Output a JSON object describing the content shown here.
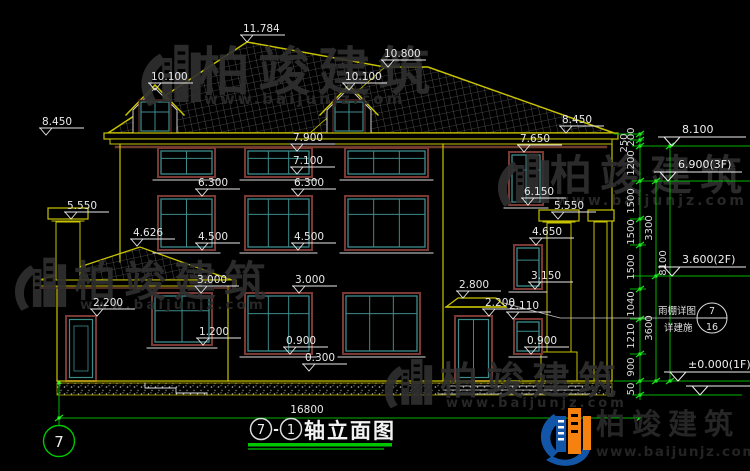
{
  "colors": {
    "cad_yellow": "#c9c400",
    "cad_green": "#00b400",
    "green_dot": "#2bff2b",
    "dim_white": "#e8e8e8",
    "frame_brown": "#7a3a33",
    "frame_teal": "#3d8c8c",
    "watermark_gray": "#2f2f2f",
    "logo_blue": "#1356a8",
    "logo_orange": "#f5820f"
  },
  "brand": {
    "name": "柏竣建筑",
    "url": "www.baijunjz.com"
  },
  "title_block": {
    "axis_a": "7",
    "dash": "-",
    "axis_b": "1",
    "text": "轴立面图"
  },
  "bottom": {
    "overall_dim": "16800",
    "grid_bubble": "7"
  },
  "callout": {
    "line1": "雨棚详图",
    "line2": "详建施",
    "detail_no": "7",
    "sheet_no": "16"
  },
  "drawing": {
    "marks": [
      {
        "t": "11.784",
        "x": 247,
        "y": 42
      },
      {
        "t": "10.100",
        "x": 155,
        "y": 90
      },
      {
        "t": "10.100",
        "x": 349,
        "y": 90
      },
      {
        "t": "10.800",
        "x": 388,
        "y": 67
      },
      {
        "t": "8.450",
        "x": 46,
        "y": 135
      },
      {
        "t": "8.450",
        "x": 566,
        "y": 133
      },
      {
        "t": "7.900",
        "x": 297,
        "y": 151
      },
      {
        "t": "7.650",
        "x": 524,
        "y": 152
      },
      {
        "t": "7.100",
        "x": 297,
        "y": 174
      },
      {
        "t": "6.300",
        "x": 202,
        "y": 196
      },
      {
        "t": "6.300",
        "x": 298,
        "y": 196
      },
      {
        "t": "6.150",
        "x": 528,
        "y": 205
      },
      {
        "t": "5.550",
        "x": 71,
        "y": 219
      },
      {
        "t": "5.550",
        "x": 558,
        "y": 219
      },
      {
        "t": "4.626",
        "x": 137,
        "y": 246
      },
      {
        "t": "4.500",
        "x": 202,
        "y": 250
      },
      {
        "t": "4.500",
        "x": 298,
        "y": 250
      },
      {
        "t": "4.650",
        "x": 536,
        "y": 245
      },
      {
        "t": "3.150",
        "x": 535,
        "y": 289
      },
      {
        "t": "3.000",
        "x": 201,
        "y": 293
      },
      {
        "t": "3.000",
        "x": 299,
        "y": 293
      },
      {
        "t": "2.800",
        "x": 463,
        "y": 298
      },
      {
        "t": "2.200",
        "x": 97,
        "y": 316
      },
      {
        "t": "2.200",
        "x": 489,
        "y": 316
      },
      {
        "t": "2.110",
        "x": 513,
        "y": 319
      },
      {
        "t": "1.200",
        "x": 203,
        "y": 345
      },
      {
        "t": "0.900",
        "x": 290,
        "y": 354
      },
      {
        "t": "0.900",
        "x": 531,
        "y": 354
      },
      {
        "t": "0.300",
        "x": 309,
        "y": 371
      }
    ],
    "levels": [
      {
        "t": "8.100",
        "x": 672,
        "y": 146
      },
      {
        "t": "6.900(3F)",
        "x": 668,
        "y": 181
      },
      {
        "t": "3.600(2F)",
        "x": 672,
        "y": 276
      },
      {
        "t": "±0.000(1F)",
        "x": 678,
        "y": 381
      },
      {
        "t": "",
        "x": 700,
        "y": 395
      }
    ],
    "chain": [
      {
        "x": 634,
        "y": 137,
        "t": "200"
      },
      {
        "x": 627,
        "y": 143,
        "t": "250"
      },
      {
        "x": 634,
        "y": 163,
        "t": "1200"
      },
      {
        "x": 634,
        "y": 201,
        "t": "1500"
      },
      {
        "x": 634,
        "y": 232,
        "t": "1500"
      },
      {
        "x": 634,
        "y": 267,
        "t": "1500"
      },
      {
        "x": 634,
        "y": 304,
        "t": "1040"
      },
      {
        "x": 634,
        "y": 336,
        "t": "1210"
      },
      {
        "x": 634,
        "y": 367,
        "t": "900"
      },
      {
        "x": 634,
        "y": 389,
        "t": "50"
      },
      {
        "x": 652,
        "y": 228,
        "t": "3300"
      },
      {
        "x": 652,
        "y": 328,
        "t": "3600"
      },
      {
        "x": 666,
        "y": 263,
        "t": "8100"
      }
    ],
    "chain_ticks": {
      "a": [
        134,
        140,
        146,
        181,
        219,
        245,
        289,
        319,
        354,
        381,
        395
      ],
      "b": [
        181,
        276,
        381
      ],
      "c": [
        146,
        381
      ]
    },
    "windows": [
      {
        "x": 158,
        "y": 148,
        "w": 57,
        "h": 29,
        "c": 2
      },
      {
        "x": 245,
        "y": 148,
        "w": 67,
        "h": 29,
        "c": 3
      },
      {
        "x": 345,
        "y": 148,
        "w": 83,
        "h": 29,
        "c": 3
      },
      {
        "x": 158,
        "y": 196,
        "w": 57,
        "h": 54,
        "c": 2
      },
      {
        "x": 245,
        "y": 196,
        "w": 67,
        "h": 54,
        "c": 3
      },
      {
        "x": 345,
        "y": 196,
        "w": 83,
        "h": 54,
        "c": 3
      },
      {
        "x": 152,
        "y": 293,
        "w": 60,
        "h": 52,
        "c": 2
      },
      {
        "x": 245,
        "y": 293,
        "w": 67,
        "h": 61,
        "c": 3
      },
      {
        "x": 343,
        "y": 293,
        "w": 77,
        "h": 61,
        "c": 3
      },
      {
        "x": 509,
        "y": 152,
        "w": 34,
        "h": 53,
        "c": 2
      },
      {
        "x": 514,
        "y": 245,
        "w": 28,
        "h": 44,
        "c": 1
      },
      {
        "x": 514,
        "y": 319,
        "w": 28,
        "h": 35,
        "c": 1
      }
    ],
    "doors": [
      {
        "x": 66,
        "y": 316,
        "w": 30,
        "h": 65,
        "panel": true
      },
      {
        "x": 455,
        "y": 316,
        "w": 37,
        "h": 65,
        "panel": false
      }
    ],
    "watermarks": [
      {
        "gx": 138,
        "gy": 36,
        "gs": 1.1,
        "tx": 198,
        "ty": 90,
        "fs": 52,
        "ux": 204,
        "uy": 104,
        "ufs": 15
      },
      {
        "gx": 495,
        "gy": 146,
        "gs": 0.95,
        "tx": 550,
        "ty": 190,
        "fs": 42,
        "ux": 556,
        "uy": 205,
        "ufs": 14
      },
      {
        "gx": 12,
        "gy": 250,
        "gs": 0.95,
        "tx": 74,
        "ty": 296,
        "fs": 42,
        "ux": 80,
        "uy": 309,
        "ufs": 13.5
      },
      {
        "gx": 382,
        "gy": 352,
        "gs": 0.88,
        "tx": 440,
        "ty": 394,
        "fs": 38,
        "ux": 446,
        "uy": 407,
        "ufs": 13
      }
    ]
  }
}
